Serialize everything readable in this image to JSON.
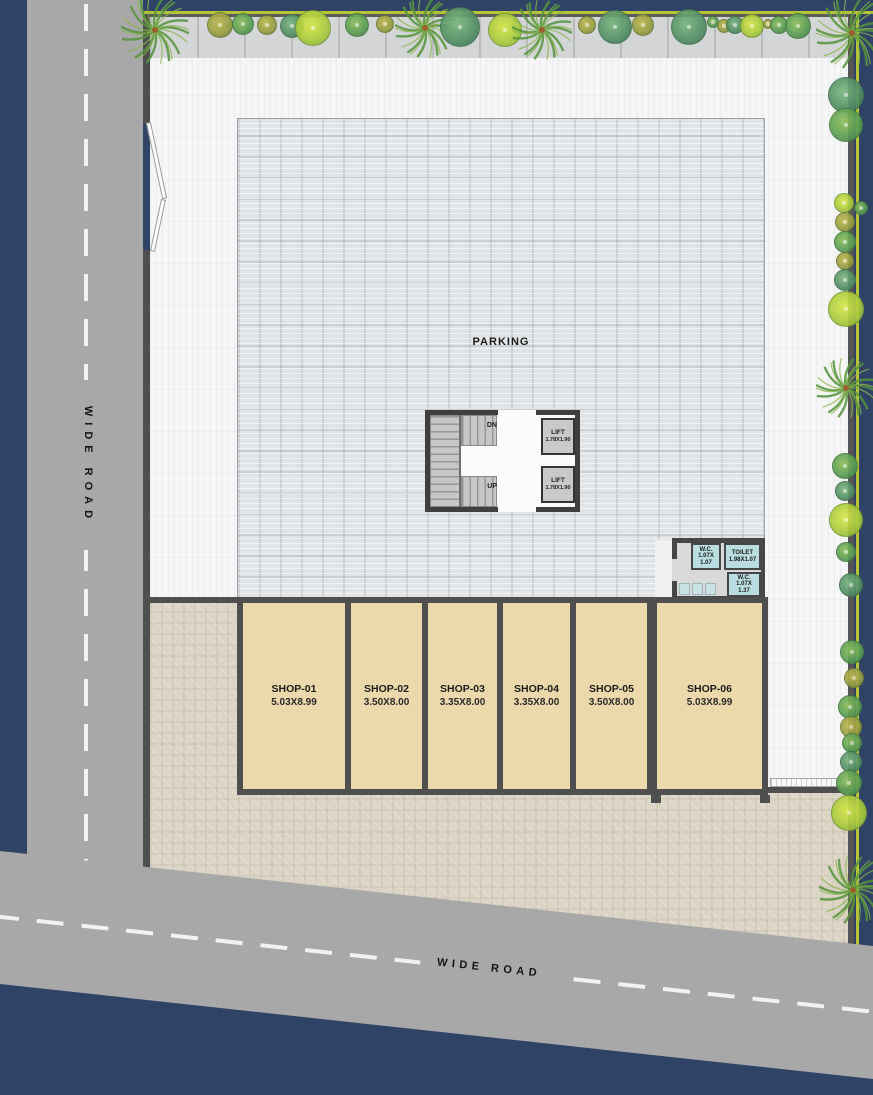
{
  "plan": {
    "type": "ground-floor site plan"
  },
  "roads": {
    "west_label": "WIDE ROAD",
    "south_label": "WIDE ROAD"
  },
  "parking": {
    "label": "PARKING"
  },
  "stairs": {
    "down": "DN",
    "up": "UP"
  },
  "lifts": [
    {
      "label": "LIFT",
      "size": "1.78X1.90"
    },
    {
      "label": "LIFT",
      "size": "1.78X1.90"
    }
  ],
  "sanitary": {
    "wc_north": {
      "lines": [
        "W.C.",
        "1.07X",
        "1.07"
      ]
    },
    "toilet": {
      "lines": [
        "TOILET",
        "1.98X1.07"
      ]
    },
    "wc_east": {
      "lines": [
        "W.C.",
        "1.07X",
        "1.37"
      ]
    }
  },
  "shops": [
    {
      "name": "SHOP-01",
      "size": "5.03X8.99"
    },
    {
      "name": "SHOP-02",
      "size": "3.50X8.00"
    },
    {
      "name": "SHOP-03",
      "size": "3.35X8.00"
    },
    {
      "name": "SHOP-04",
      "size": "3.35X8.00"
    },
    {
      "name": "SHOP-05",
      "size": "3.50X8.00"
    },
    {
      "name": "SHOP-06",
      "size": "5.03X8.99"
    }
  ],
  "colors": {
    "background_blue": "#2e4366",
    "road_gray": "#a8a8a8",
    "lane_dash_white": "#f2f2f2",
    "boundary_yellow": "#b8c437",
    "wall_dark": "#4f4f4f",
    "open_space_white": "#f6f6f7",
    "parking_gray": "#e0e4e7",
    "shop_tan": "#ecd9ab",
    "ground_beige": "#dcd5c6",
    "sanitary_cyan": "#b9dde0",
    "tree_green": "#5d9f55",
    "tree_olive": "#9aa043",
    "tree_teal": "#569167",
    "tree_lime": "#a8c93e"
  }
}
